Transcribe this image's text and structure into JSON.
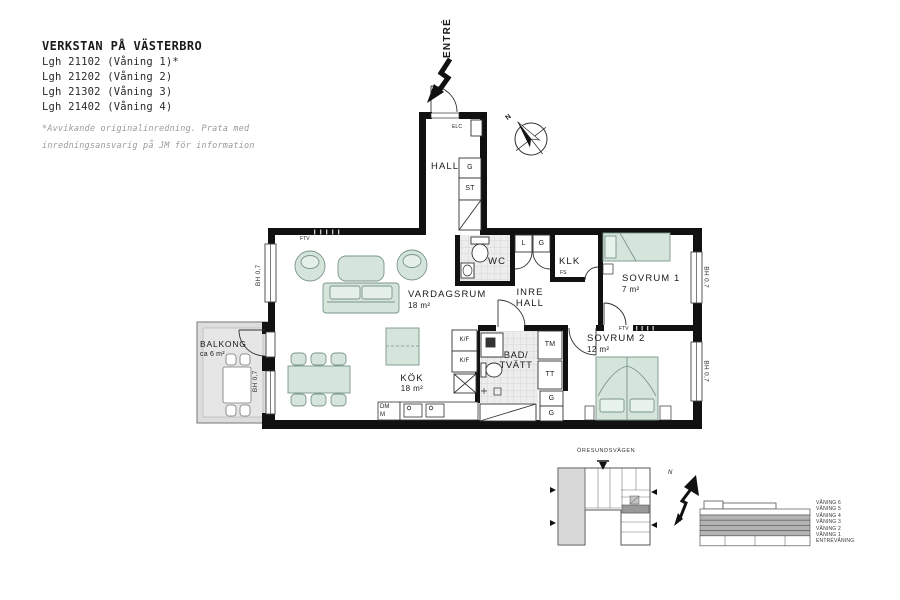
{
  "header": {
    "project_title": "VERKSTAN PÅ VÄSTERBRO",
    "apartments": [
      "Lgh 21102 (Våning 1)*",
      "Lgh 21202 (Våning 2)",
      "Lgh 21302 (Våning 3)",
      "Lgh 21402 (Våning 4)"
    ],
    "footnote": [
      "*Avvikande originalinredning. Prata med",
      "inredningsansvarig på JM för information"
    ]
  },
  "plan": {
    "entry_label": "ENTRÉ",
    "compass_north": "N",
    "window_height_label": "BH 0,7",
    "rooms": {
      "hall": {
        "name": "HALL"
      },
      "vardagsrum": {
        "name": "VARDAGSRUM",
        "area": "18 m²"
      },
      "kok": {
        "name": "KÖK",
        "area": "18 m²"
      },
      "wc": {
        "name": "WC"
      },
      "klk": {
        "name": "KLK"
      },
      "inre_hall": {
        "line1": "INRE",
        "line2": "HALL"
      },
      "sovrum1": {
        "name": "SOVRUM 1",
        "area": "7 m²"
      },
      "sovrum2": {
        "name": "SOVRUM 2",
        "area": "12 m²"
      },
      "bad": {
        "line1": "BAD/",
        "line2": "TVÄTT"
      },
      "balkong": {
        "name": "BALKONG",
        "area": "ca 6 m²"
      }
    },
    "fixtures": {
      "g": "G",
      "st": "ST",
      "l": "L",
      "kf": "K/F",
      "tm": "TM",
      "tt": "TT",
      "dm": "DM",
      "m": "M",
      "fs": "FS",
      "ftv": "FTV",
      "elc": "ELC"
    }
  },
  "locator": {
    "street": "ÖRESUNDSVÄGEN",
    "north": "N",
    "floors": [
      "VÅNING 6",
      "VÅNING 5",
      "VÅNING 4",
      "VÅNING 3",
      "VÅNING 2",
      "VÅNING 1",
      "ENTRÉVÅNING"
    ]
  },
  "colors": {
    "wall": "#111111",
    "furniture_green": "#d5e5db",
    "balcony_gray": "#dddddd",
    "highlight_unit_gray": "#999999"
  }
}
